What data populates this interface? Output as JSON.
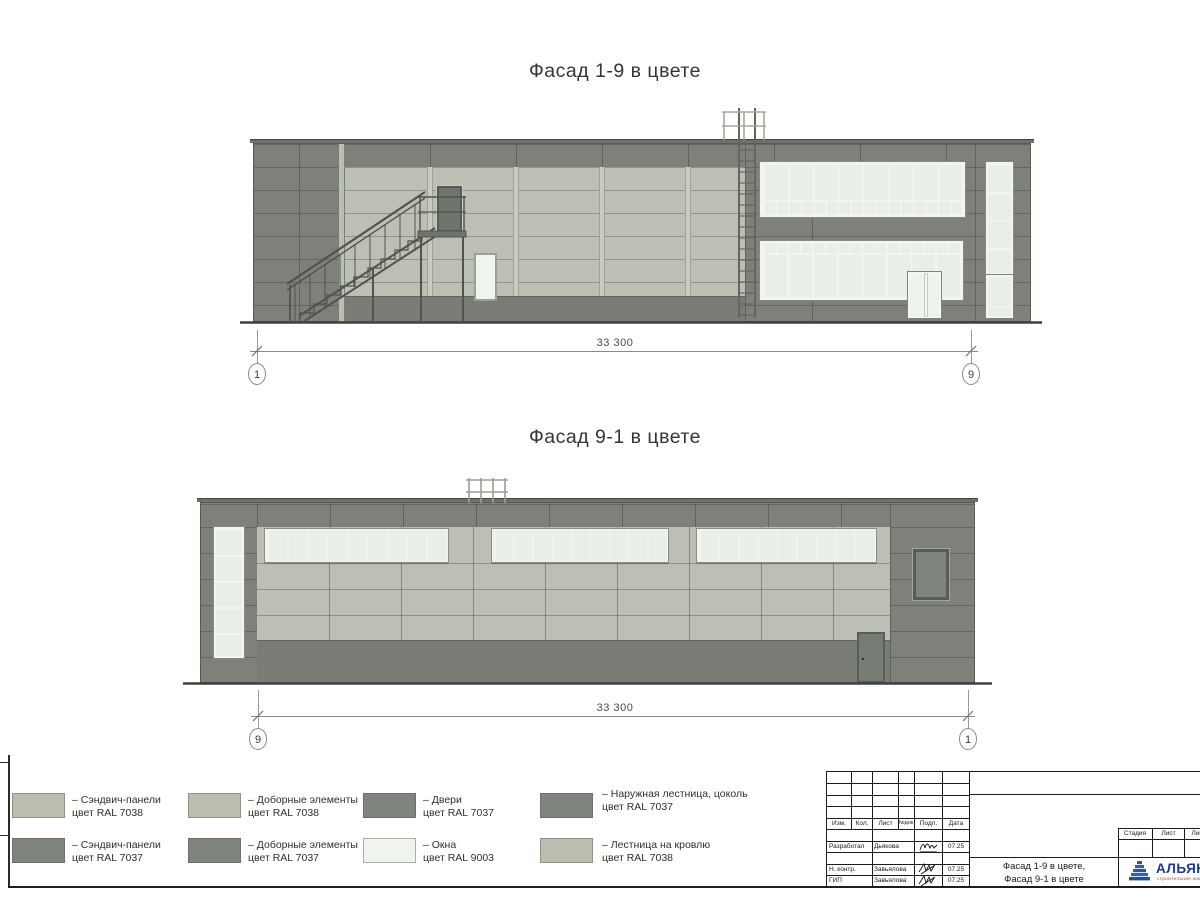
{
  "sheet": {
    "facade_top_title": "Фасад 1-9 в цвете",
    "facade_bottom_title": "Фасад 9-1 в цвете"
  },
  "dimensions": {
    "top": {
      "value": "33 300",
      "axis_left": "1",
      "axis_right": "9"
    },
    "bottom": {
      "value": "33 300",
      "axis_left": "9",
      "axis_right": "1"
    }
  },
  "legend": {
    "items": [
      {
        "line1": "– Сэндвич-панели",
        "line2": "цвет RAL 7038",
        "ral": "RAL 7038",
        "color": "#b9beb0"
      },
      {
        "line1": "– Сэндвич-панели",
        "line2": "цвет RAL 7037",
        "ral": "RAL 7037",
        "color": "#7f847d"
      },
      {
        "line1": "– Доборные элементы",
        "line2": "цвет RAL 7038",
        "ral": "RAL 7038",
        "color": "#b9beb0"
      },
      {
        "line1": "– Доборные элементы",
        "line2": "цвет RAL 7037",
        "ral": "RAL 7037",
        "color": "#7f847d"
      },
      {
        "line1": "– Двери",
        "line2": "цвет RAL 7037",
        "ral": "RAL 7037",
        "color": "#7f847d"
      },
      {
        "line1": "– Окна",
        "line2": "цвет RAL 9003",
        "ral": "RAL 9003",
        "color": "#f0f4ee"
      },
      {
        "line1": "– Наружная лестница, цоколь",
        "line2": "цвет RAL 7037",
        "ral": "RAL 7037",
        "color": "#7f847d"
      },
      {
        "line1": "– Лестница на кровлю",
        "line2": "цвет RAL 7038",
        "ral": "RAL 7038",
        "color": "#b9beb0"
      }
    ]
  },
  "title_block": {
    "revision_header": {
      "izm": "Изм.",
      "kol": "Кол.",
      "list": "Лист",
      "ndok": "№док",
      "podp": "Подп.",
      "data": "Дата"
    },
    "signature_rows": [
      {
        "role": "Разработал",
        "name": "Дьякова",
        "date": "07.25"
      },
      {
        "role": "Н. контр.",
        "name": "Завьялова",
        "date": "07.25"
      },
      {
        "role": "ГИП",
        "name": "Завьялова",
        "date": "07.25"
      }
    ],
    "doc_title_line1": "Фасад 1-9 в цвете,",
    "doc_title_line2": "Фасад 9-1 в цвете",
    "stage_header": {
      "stage": "Стадия",
      "sheet": "Лист",
      "sheets": "Листов"
    },
    "logo": {
      "name": "АЛЬЯНС",
      "subtitle": "строительная компания"
    }
  },
  "colors": {
    "ral_7037_dark_grey": "#7d817a",
    "ral_7038_light_grey": "#bcc0b4",
    "ral_9003_window_white": "#eff3ec",
    "plinth": "#787c74",
    "logo_blue": "#1d3a8f",
    "logo_red": "#bf3a30"
  }
}
